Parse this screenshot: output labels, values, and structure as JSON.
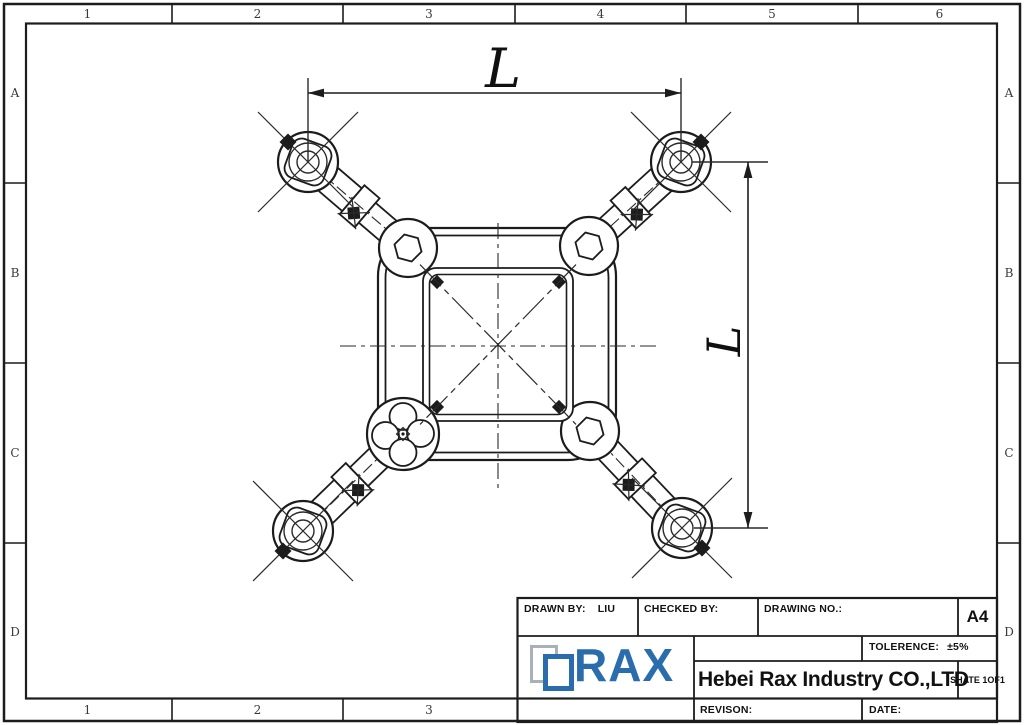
{
  "zones": {
    "top": [
      "1",
      "2",
      "3",
      "4",
      "5",
      "6"
    ],
    "bottom": [
      "1",
      "2",
      "3"
    ],
    "left": [
      "A",
      "B",
      "C",
      "D"
    ],
    "right": [
      "A",
      "B",
      "C",
      "D"
    ]
  },
  "drawing": {
    "dim_width_label": "L",
    "dim_height_label": "L"
  },
  "title_block": {
    "drawn_by_label": "DRAWN BY:",
    "drawn_by_value": "LIU",
    "checked_by_label": "CHECKED BY:",
    "drawing_no_label": "DRAWING NO.:",
    "paper_size": "A4",
    "tolerance_label": "TOLERENCE:",
    "tolerance_value": "±5%",
    "company_name": "Hebei Rax Industry CO.,LTD",
    "sheet_label": "SHATE 1OF1",
    "revision_label": "REVISON:",
    "date_label": "DATE:",
    "logo_text": "RAX"
  },
  "colors": {
    "logo_blue": "#2a6dad",
    "ink": "#1c1c1c",
    "paper": "#ffffff"
  }
}
